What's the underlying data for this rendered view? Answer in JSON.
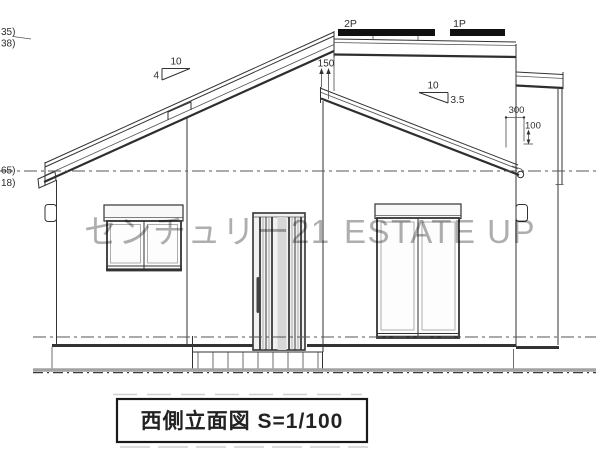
{
  "title_block": {
    "title": "西側立面図 S=1/100"
  },
  "watermark": {
    "left": "センチュリー21",
    "right": "ESTATE UP"
  },
  "labels": {
    "panel_left": "2P",
    "panel_right": "1P"
  },
  "dimensions": {
    "parapet_height": "150",
    "eave_offset": "300",
    "eave_step": "100",
    "slope_left_run": "10",
    "slope_left_rise": "4",
    "slope_right_run": "10",
    "slope_right_rise": "3.5"
  },
  "level_marks": {
    "top_upper": "35)",
    "top_lower": "38)",
    "mid_upper": "65)",
    "mid_lower": "18)"
  },
  "colors": {
    "line": "#333333",
    "solar_panel": "#101010",
    "watermark": "#8f8f8f",
    "background": "#ffffff"
  }
}
